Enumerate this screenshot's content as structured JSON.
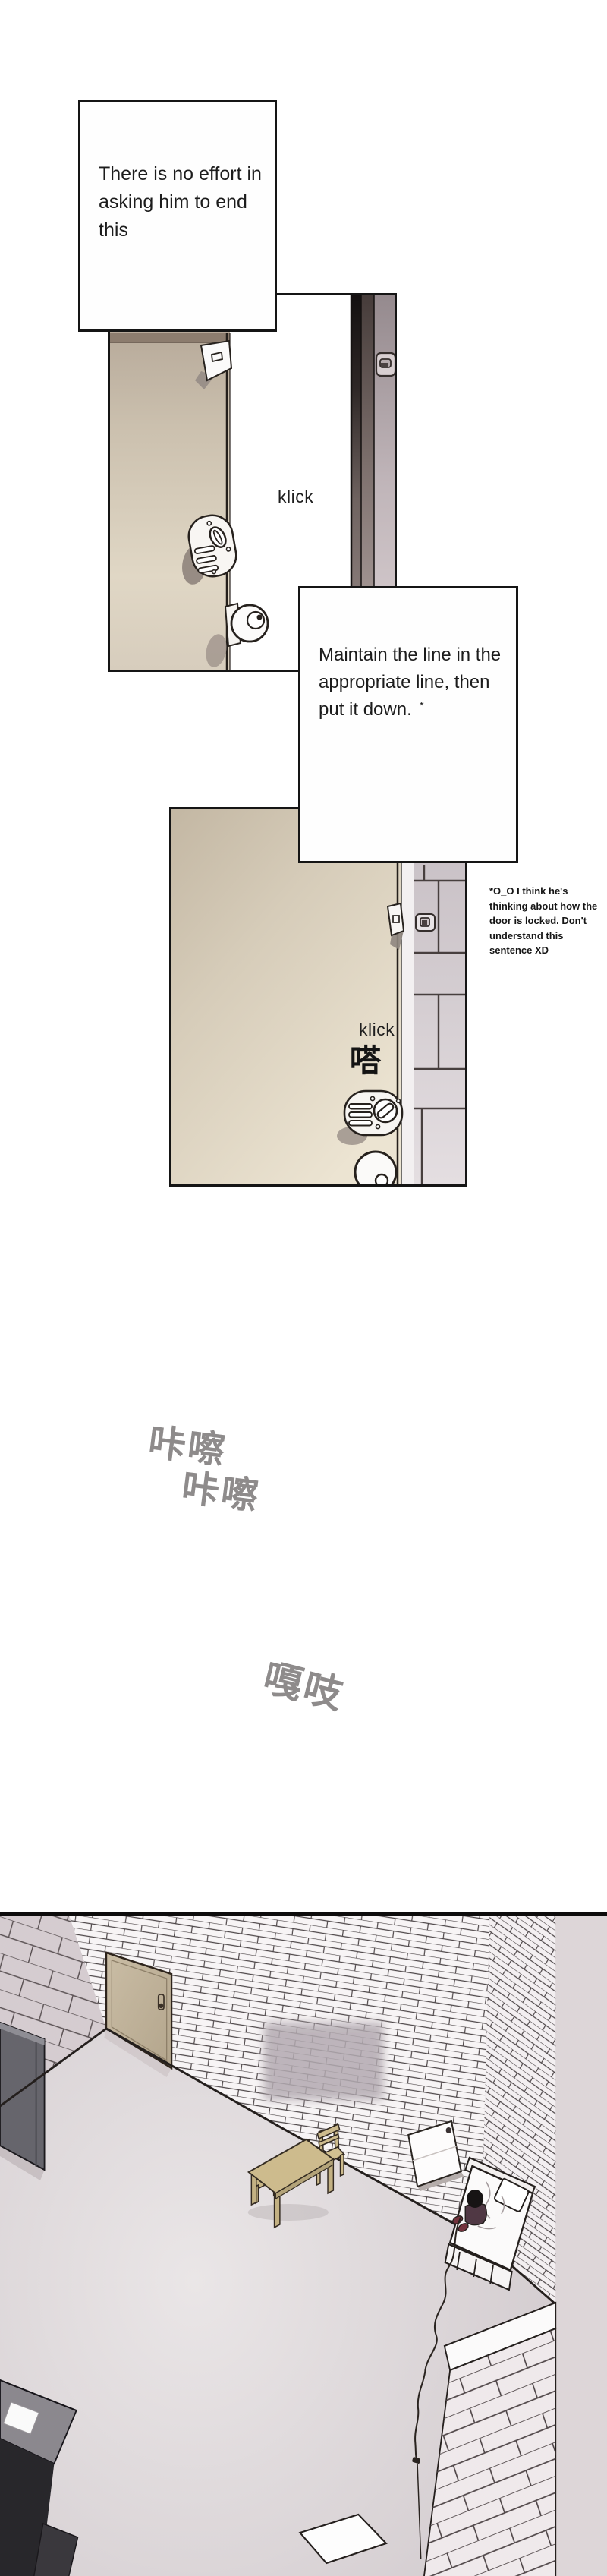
{
  "colors": {
    "ink": "#141414",
    "panel_border": "#151515",
    "door_beige_light": "#e4dbc9",
    "door_beige_dark": "#b0a293",
    "door_frame_mauve": "#a2959a",
    "tile_mauve": "#cfc7cb",
    "sfx_gray": "#8e8b8b",
    "wood_tan": "#cdbb8d",
    "wardrobe_gray": "#66656c",
    "slipper_maroon": "#73323c"
  },
  "caption_box_1": {
    "lines": [
      "There is no effort in",
      "asking him to end this"
    ]
  },
  "panel_1": {
    "sfx_klick": "klick"
  },
  "caption_box_2": {
    "lines": [
      "Maintain the line in the",
      "appropriate line, then",
      "put it down."
    ],
    "footnote_marker": "*"
  },
  "translator_note": {
    "lines": [
      "*O_O I think he's",
      "thinking about how the",
      "door is locked. Don't",
      "understand this",
      "sentence XD"
    ]
  },
  "panel_2": {
    "sfx_klick": "klick",
    "sfx_click_cjk": "嗒"
  },
  "sfx_floating": {
    "kacha_1": "咔嚓",
    "kacha_2": "咔嚓",
    "gazhi": "嘎吱"
  }
}
